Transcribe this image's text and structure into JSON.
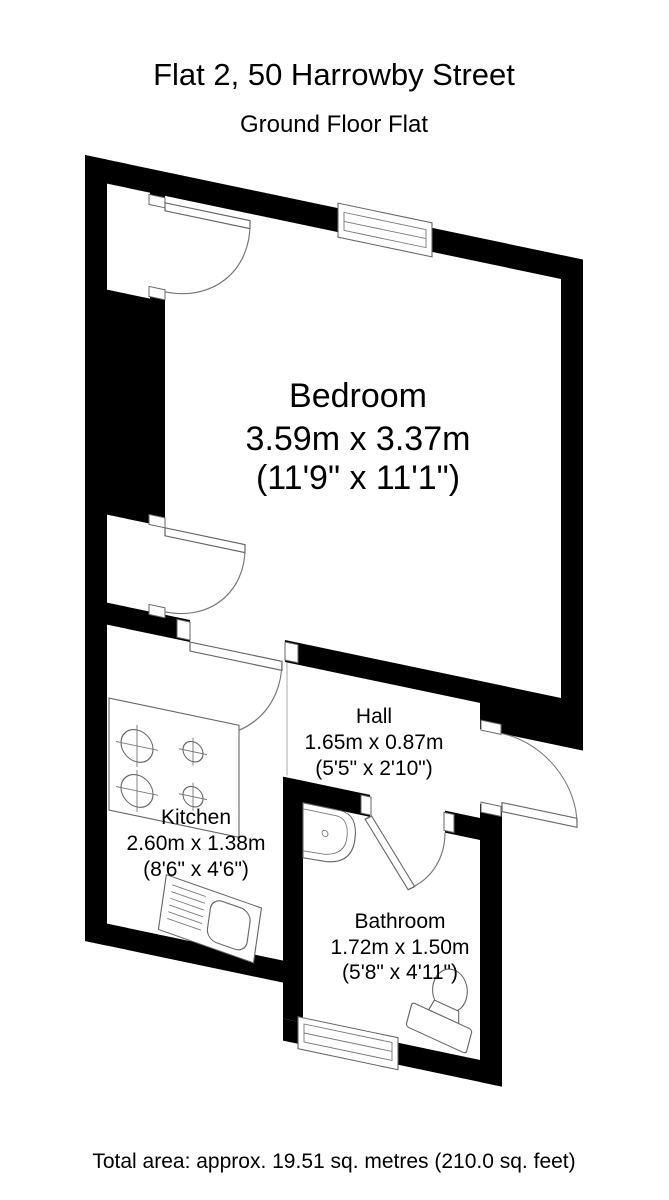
{
  "document": {
    "title": "Flat 2, 50 Harrowby Street",
    "subtitle": "Ground Floor Flat",
    "footer": "Total area: approx. 19.51 sq. metres (210.0 sq. feet)"
  },
  "rooms": {
    "bedroom": {
      "name": "Bedroom",
      "metric": "3.59m x 3.37m",
      "imperial": "(11'9\" x 11'1\")"
    },
    "hall": {
      "name": "Hall",
      "metric": "1.65m x 0.87m",
      "imperial": "(5'5\" x 2'10\")"
    },
    "kitchen": {
      "name": "Kitchen",
      "metric": "2.60m x 1.38m",
      "imperial": "(8'6\" x 4'6\")"
    },
    "bathroom": {
      "name": "Bathroom",
      "metric": "1.72m x 1.50m",
      "imperial": "(5'8\" x 4'11\")"
    }
  },
  "colors": {
    "wall": "#000000",
    "background": "#ffffff",
    "fixture_outline": "#666666",
    "text": "#000000"
  }
}
